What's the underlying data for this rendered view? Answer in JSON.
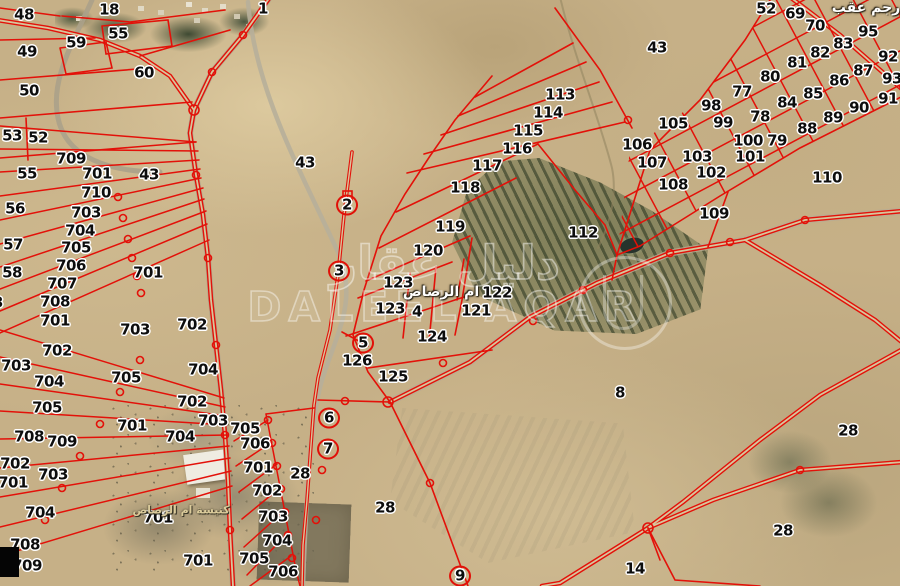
{
  "map": {
    "watermark": {
      "arabic": "دليل عقار",
      "latin": "DALEEL AQAR"
    },
    "place_labels": [
      {
        "text": "رجم عقب",
        "x": 866,
        "y": 8,
        "style": "white"
      },
      {
        "text": "ام الرصاص",
        "x": 441,
        "y": 292,
        "style": "white"
      },
      {
        "text": "كنيسة ام الرصاص",
        "x": 181,
        "y": 510,
        "style": "tan"
      }
    ],
    "colors": {
      "parcel_line_red": "#e31109",
      "label_text": "#0d0d0d",
      "label_halo": "#ffffff"
    },
    "parcel_labels": [
      {
        "n": "48",
        "x": 24,
        "y": 15
      },
      {
        "n": "18",
        "x": 109,
        "y": 10
      },
      {
        "n": "1",
        "x": 263,
        "y": 9
      },
      {
        "n": "55",
        "x": 118,
        "y": 34
      },
      {
        "n": "59",
        "x": 76,
        "y": 43
      },
      {
        "n": "49",
        "x": 27,
        "y": 52
      },
      {
        "n": "60",
        "x": 144,
        "y": 73
      },
      {
        "n": "50",
        "x": 29,
        "y": 91
      },
      {
        "n": "53",
        "x": 12,
        "y": 136
      },
      {
        "n": "52",
        "x": 38,
        "y": 138
      },
      {
        "n": "709",
        "x": 71,
        "y": 159
      },
      {
        "n": "55",
        "x": 27,
        "y": 174
      },
      {
        "n": "701",
        "x": 97,
        "y": 174
      },
      {
        "n": "710",
        "x": 96,
        "y": 193
      },
      {
        "n": "43",
        "x": 149,
        "y": 175
      },
      {
        "n": "43",
        "x": 305,
        "y": 163
      },
      {
        "n": "56",
        "x": 15,
        "y": 209
      },
      {
        "n": "703",
        "x": 86,
        "y": 213
      },
      {
        "n": "704",
        "x": 80,
        "y": 231
      },
      {
        "n": "57",
        "x": 13,
        "y": 245
      },
      {
        "n": "705",
        "x": 76,
        "y": 248
      },
      {
        "n": "706",
        "x": 71,
        "y": 266
      },
      {
        "n": "58",
        "x": 12,
        "y": 273
      },
      {
        "n": "707",
        "x": 62,
        "y": 284
      },
      {
        "n": "708",
        "x": 55,
        "y": 302
      },
      {
        "n": "703",
        "x": -12,
        "y": 303
      },
      {
        "n": "701",
        "x": 55,
        "y": 321
      },
      {
        "n": "701",
        "x": 148,
        "y": 273
      },
      {
        "n": "702",
        "x": 192,
        "y": 325
      },
      {
        "n": "703",
        "x": 135,
        "y": 330
      },
      {
        "n": "702",
        "x": 57,
        "y": 351
      },
      {
        "n": "703",
        "x": 16,
        "y": 366
      },
      {
        "n": "704",
        "x": 49,
        "y": 382
      },
      {
        "n": "705",
        "x": 47,
        "y": 408
      },
      {
        "n": "705",
        "x": 126,
        "y": 378
      },
      {
        "n": "704",
        "x": 203,
        "y": 370
      },
      {
        "n": "702",
        "x": 192,
        "y": 402
      },
      {
        "n": "703",
        "x": 213,
        "y": 421
      },
      {
        "n": "701",
        "x": 132,
        "y": 426
      },
      {
        "n": "704",
        "x": 180,
        "y": 437
      },
      {
        "n": "708",
        "x": 29,
        "y": 437
      },
      {
        "n": "709",
        "x": 62,
        "y": 442
      },
      {
        "n": "702",
        "x": 15,
        "y": 464
      },
      {
        "n": "701",
        "x": 13,
        "y": 483
      },
      {
        "n": "703",
        "x": 53,
        "y": 475
      },
      {
        "n": "704",
        "x": 40,
        "y": 513
      },
      {
        "n": "708",
        "x": 25,
        "y": 545
      },
      {
        "n": "709",
        "x": 27,
        "y": 566
      },
      {
        "n": "701",
        "x": 158,
        "y": 518
      },
      {
        "n": "701",
        "x": 198,
        "y": 561
      },
      {
        "n": "705",
        "x": 245,
        "y": 429
      },
      {
        "n": "706",
        "x": 255,
        "y": 444
      },
      {
        "n": "701",
        "x": 258,
        "y": 468
      },
      {
        "n": "702",
        "x": 267,
        "y": 491
      },
      {
        "n": "703",
        "x": 273,
        "y": 517
      },
      {
        "n": "704",
        "x": 277,
        "y": 541
      },
      {
        "n": "705",
        "x": 254,
        "y": 559
      },
      {
        "n": "706",
        "x": 283,
        "y": 572
      },
      {
        "n": "2",
        "x": 347,
        "y": 205,
        "c": true
      },
      {
        "n": "3",
        "x": 339,
        "y": 271,
        "c": true
      },
      {
        "n": "5",
        "x": 363,
        "y": 343,
        "c": true
      },
      {
        "n": "6",
        "x": 329,
        "y": 418,
        "c": true
      },
      {
        "n": "7",
        "x": 328,
        "y": 449,
        "c": true
      },
      {
        "n": "4",
        "x": 417,
        "y": 312
      },
      {
        "n": "9",
        "x": 460,
        "y": 576,
        "c": true
      },
      {
        "n": "28",
        "x": 300,
        "y": 474
      },
      {
        "n": "28",
        "x": 385,
        "y": 508
      },
      {
        "n": "28",
        "x": 848,
        "y": 431
      },
      {
        "n": "28",
        "x": 783,
        "y": 531
      },
      {
        "n": "123",
        "x": 398,
        "y": 283
      },
      {
        "n": "123",
        "x": 390,
        "y": 309
      },
      {
        "n": "122",
        "x": 497,
        "y": 293
      },
      {
        "n": "121",
        "x": 476,
        "y": 311
      },
      {
        "n": "124",
        "x": 432,
        "y": 337
      },
      {
        "n": "126",
        "x": 357,
        "y": 361
      },
      {
        "n": "125",
        "x": 393,
        "y": 377
      },
      {
        "n": "119",
        "x": 450,
        "y": 227
      },
      {
        "n": "120",
        "x": 428,
        "y": 251
      },
      {
        "n": "118",
        "x": 465,
        "y": 188
      },
      {
        "n": "117",
        "x": 487,
        "y": 166
      },
      {
        "n": "116",
        "x": 517,
        "y": 149
      },
      {
        "n": "115",
        "x": 528,
        "y": 131
      },
      {
        "n": "114",
        "x": 548,
        "y": 113
      },
      {
        "n": "113",
        "x": 560,
        "y": 95
      },
      {
        "n": "112",
        "x": 583,
        "y": 233
      },
      {
        "n": "8",
        "x": 620,
        "y": 393
      },
      {
        "n": "14",
        "x": 635,
        "y": 569
      },
      {
        "n": "43",
        "x": 657,
        "y": 48
      },
      {
        "n": "52",
        "x": 766,
        "y": 9
      },
      {
        "n": "69",
        "x": 795,
        "y": 14
      },
      {
        "n": "70",
        "x": 815,
        "y": 26
      },
      {
        "n": "95",
        "x": 868,
        "y": 32
      },
      {
        "n": "83",
        "x": 843,
        "y": 44
      },
      {
        "n": "82",
        "x": 820,
        "y": 53
      },
      {
        "n": "81",
        "x": 797,
        "y": 63
      },
      {
        "n": "80",
        "x": 770,
        "y": 77
      },
      {
        "n": "77",
        "x": 742,
        "y": 92
      },
      {
        "n": "98",
        "x": 711,
        "y": 106
      },
      {
        "n": "99",
        "x": 723,
        "y": 123
      },
      {
        "n": "105",
        "x": 673,
        "y": 124
      },
      {
        "n": "78",
        "x": 760,
        "y": 117
      },
      {
        "n": "100",
        "x": 748,
        "y": 141
      },
      {
        "n": "79",
        "x": 777,
        "y": 141
      },
      {
        "n": "101",
        "x": 750,
        "y": 157
      },
      {
        "n": "103",
        "x": 697,
        "y": 157
      },
      {
        "n": "102",
        "x": 711,
        "y": 173
      },
      {
        "n": "106",
        "x": 637,
        "y": 145
      },
      {
        "n": "107",
        "x": 652,
        "y": 163
      },
      {
        "n": "108",
        "x": 673,
        "y": 185
      },
      {
        "n": "109",
        "x": 714,
        "y": 214
      },
      {
        "n": "110",
        "x": 827,
        "y": 178
      },
      {
        "n": "84",
        "x": 787,
        "y": 103
      },
      {
        "n": "85",
        "x": 813,
        "y": 94
      },
      {
        "n": "86",
        "x": 839,
        "y": 81
      },
      {
        "n": "87",
        "x": 863,
        "y": 71
      },
      {
        "n": "92",
        "x": 888,
        "y": 57
      },
      {
        "n": "93",
        "x": 892,
        "y": 79
      },
      {
        "n": "91",
        "x": 888,
        "y": 99
      },
      {
        "n": "90",
        "x": 859,
        "y": 108
      },
      {
        "n": "89",
        "x": 833,
        "y": 118
      },
      {
        "n": "88",
        "x": 807,
        "y": 129
      }
    ]
  }
}
